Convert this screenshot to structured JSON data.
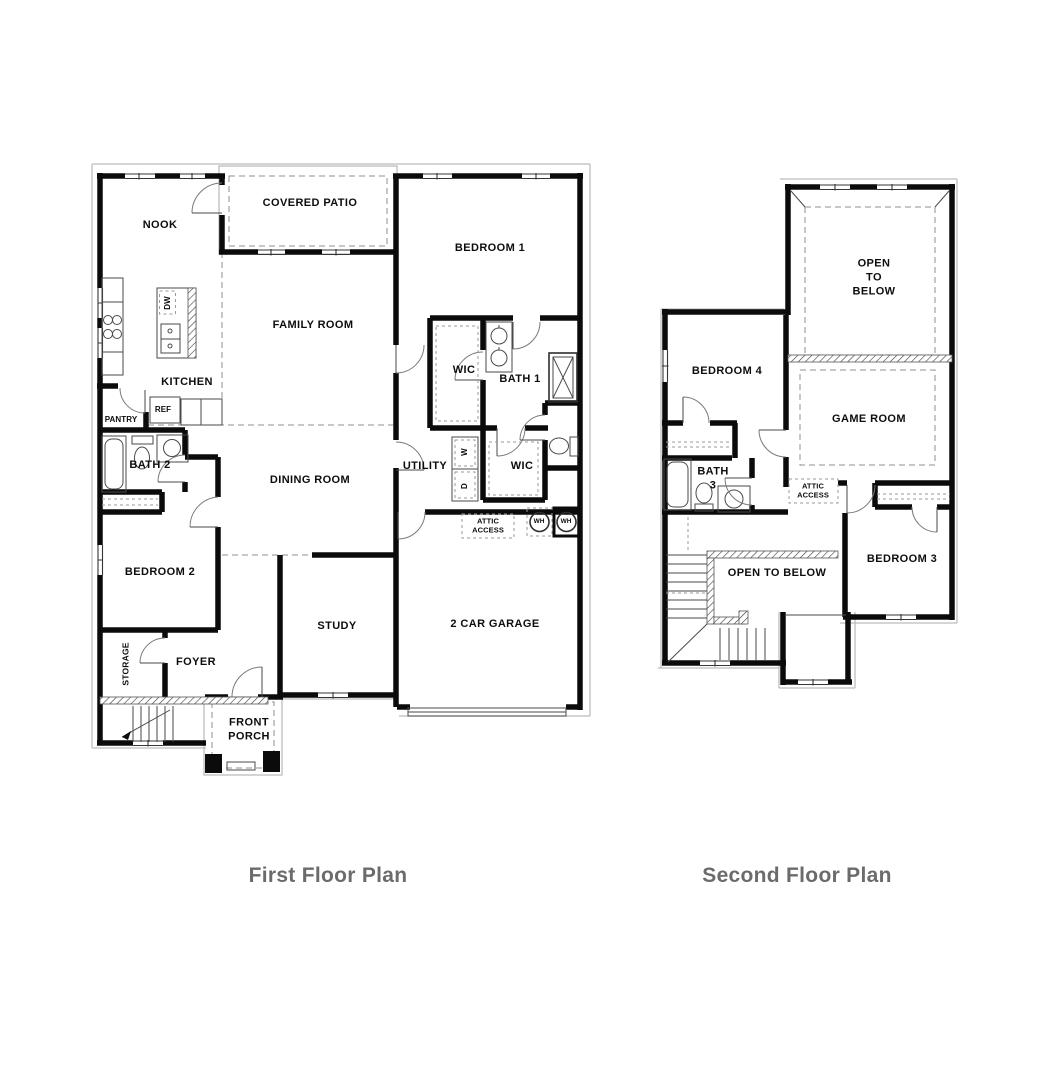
{
  "colors": {
    "wall": "#0b0b0b",
    "caption_text": "#6b6b6b",
    "background": "#ffffff"
  },
  "captions": {
    "first": "First Floor Plan",
    "second": "Second Floor Plan"
  },
  "first_floor": {
    "rooms": {
      "nook": "NOOK",
      "covered_patio": "COVERED PATIO",
      "bedroom1": "BEDROOM 1",
      "family_room": "FAMILY ROOM",
      "kitchen": "KITCHEN",
      "pantry": "PANTRY",
      "ref": "REF",
      "dw": "DW",
      "bath2": "BATH 2",
      "wic_bedroom1": "WIC",
      "bath1": "BATH 1",
      "utility": "UTILITY",
      "washer": "W",
      "dryer": "D",
      "wic_hall": "WIC",
      "dining_room": "DINING ROOM",
      "attic_access": "ATTIC\nACCESS",
      "wh_left": "WH",
      "wh_right": "WH",
      "bedroom2": "BEDROOM 2",
      "storage": "STORAGE",
      "foyer": "FOYER",
      "study": "STUDY",
      "garage": "2 CAR GARAGE",
      "front_porch": "FRONT\nPORCH"
    }
  },
  "second_floor": {
    "rooms": {
      "open_to_below_upper": "OPEN\nTO\nBELOW",
      "bedroom4": "BEDROOM 4",
      "game_room": "GAME ROOM",
      "bath3": "BATH\n3",
      "attic_access": "ATTIC\nACCESS",
      "open_to_below_stair": "OPEN TO BELOW",
      "bedroom3": "BEDROOM 3"
    }
  }
}
